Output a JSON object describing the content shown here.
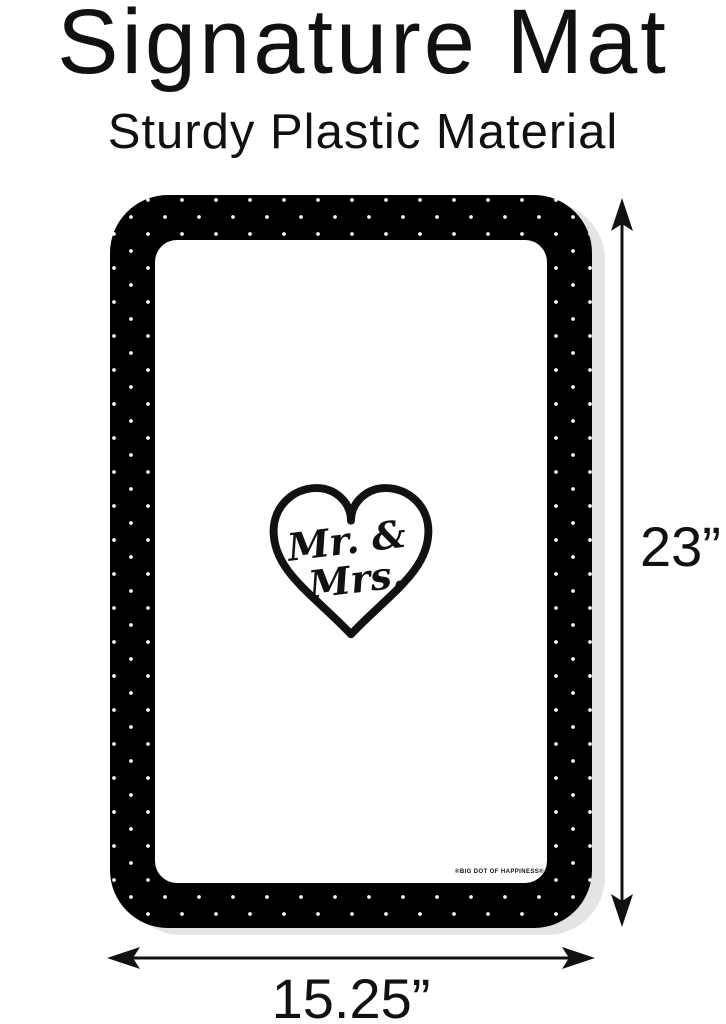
{
  "page": {
    "title": "Signature Mat",
    "subtitle": "Sturdy Plastic Material"
  },
  "mat": {
    "monogram_line1": "Mr. &",
    "monogram_line2": "Mrs.",
    "brand_mark": "®BIG DOT OF HAPPINESS®"
  },
  "dimensions": {
    "height_label": "23”",
    "width_label": "15.25”"
  },
  "icons": {
    "heart": "heart-outline-icon",
    "height_arrow": "vertical-double-headed-arrow-icon",
    "width_arrow": "horizontal-double-headed-arrow-icon"
  },
  "colors": {
    "text": "#111111",
    "mat_border": "#000000",
    "mat_dots": "#ffffff",
    "mat_surface": "#ffffff",
    "mat_shadow": "#e4e4e4",
    "background": "#ffffff"
  }
}
